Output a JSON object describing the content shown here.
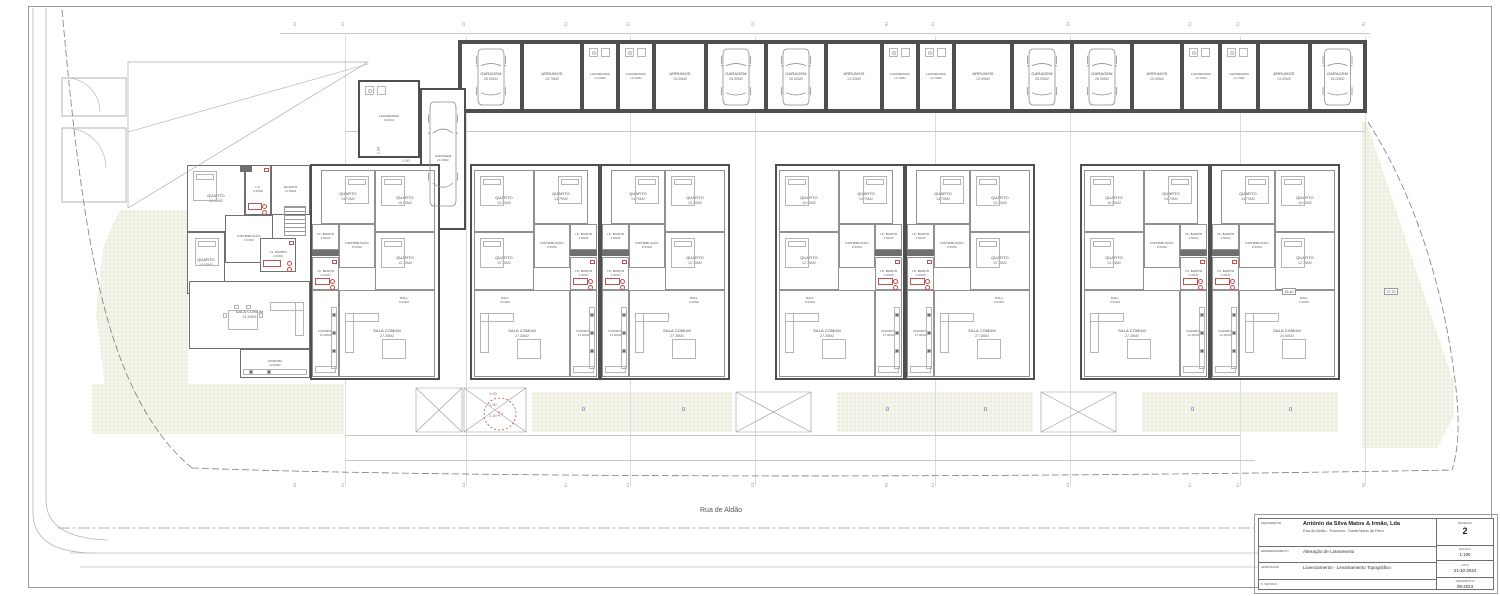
{
  "street": {
    "name": "Rua de Aldão"
  },
  "colors": {
    "wall": "#4f4f4f",
    "partition": "#919191",
    "sanitary_red": "#c0504d",
    "garden_fill": "#f4f4ea",
    "garden_dot": "#c9cfa9",
    "marker_blue": "#4059c8"
  },
  "title_block": {
    "rows": [
      {
        "label": "REQUERENTE",
        "line1": "António da Silva Matos & Irmão, Lda",
        "line2": "Rua de Aldão - Travanca - Santa Maria da Feira"
      },
      {
        "label": "EMPREENDIMENTO",
        "line1": "Alteração de Loteamento",
        "line2": ""
      },
      {
        "label": "APROVAÇÃO",
        "line1": "Licenciamento - Levantamento Topográfico",
        "line2": ""
      },
      {
        "label": "O TÉCNICO",
        "line1": "",
        "line2": ""
      }
    ],
    "meta": [
      {
        "label": "DESENHO",
        "value": "2"
      },
      {
        "label": "ESCALA",
        "value": "1:100"
      },
      {
        "label": "DATA",
        "value": "21-10-2024"
      },
      {
        "label": "REFERÊNCIA",
        "value": "09-2023"
      }
    ]
  },
  "strip_rooms": [
    {
      "x": 460,
      "w": 62,
      "name": "GARAGEM",
      "area": "26.00M2",
      "car": true
    },
    {
      "x": 522,
      "w": 60,
      "name": "ARRUMOS",
      "area": "13.75M2"
    },
    {
      "x": 582,
      "w": 36,
      "name": "LAVANDARIA",
      "area": "13.00M2"
    },
    {
      "x": 618,
      "w": 36,
      "name": "LAVANDARIA",
      "area": "13.00M2"
    },
    {
      "x": 654,
      "w": 52,
      "name": "ARRUMOS",
      "area": "13.00M2"
    },
    {
      "x": 706,
      "w": 60,
      "name": "GARAGEM",
      "area": "26.00M2",
      "car": true
    },
    {
      "x": 766,
      "w": 60,
      "name": "GARAGEM",
      "area": "26.00M2",
      "car": true
    },
    {
      "x": 826,
      "w": 56,
      "name": "ARRUMOS",
      "area": "13.00M2"
    },
    {
      "x": 882,
      "w": 36,
      "name": "LAVANDARIA",
      "area": "12.70M2"
    },
    {
      "x": 918,
      "w": 36,
      "name": "LAVANDARIA",
      "area": "12.70M2"
    },
    {
      "x": 954,
      "w": 58,
      "name": "ARRUMOS",
      "area": "13.00M2"
    },
    {
      "x": 1012,
      "w": 60,
      "name": "GARAGEM",
      "area": "26.00M2",
      "car": true
    },
    {
      "x": 1072,
      "w": 60,
      "name": "GARAGEM",
      "area": "26.00M2",
      "car": true
    },
    {
      "x": 1132,
      "w": 50,
      "name": "ARRUMOS",
      "area": "10.00M2"
    },
    {
      "x": 1182,
      "w": 38,
      "name": "LAVANDARIA",
      "area": "12.70M2"
    },
    {
      "x": 1220,
      "w": 38,
      "name": "LAVANDARIA",
      "area": "12.70M2"
    },
    {
      "x": 1258,
      "w": 52,
      "name": "ARRUMOS",
      "area": "13.00M2"
    },
    {
      "x": 1310,
      "w": 55,
      "name": "GARAGEM",
      "area": "26.00M2",
      "car": true
    }
  ],
  "outbuildings": [
    {
      "name": "LAVANDARIA",
      "area": "6.00M2",
      "x": 358,
      "y": 80,
      "w": 62,
      "h": 78
    },
    {
      "name": "GARAGEM",
      "area": "21.00M2",
      "x": 420,
      "y": 88,
      "w": 46,
      "h": 142,
      "car": true
    }
  ],
  "unit_rooms": [
    {
      "name": "QUARTO",
      "area": "15.00M2",
      "x": 2,
      "y": 4,
      "w": 60,
      "h": 62,
      "furn": "bed"
    },
    {
      "name": "QUARTO",
      "area": "14.70M2",
      "x": 62,
      "y": 4,
      "w": 54,
      "h": 54,
      "furn": "bed2"
    },
    {
      "name": "DISTRIBUIÇÃO",
      "area": "8.50M2",
      "x": 62,
      "y": 58,
      "w": 36,
      "h": 44,
      "small": true
    },
    {
      "name": "I.S. BANHO",
      "area": "4.50M2",
      "x": 98,
      "y": 58,
      "w": 27,
      "h": 26,
      "small": true
    },
    {
      "name": "QUARTO",
      "area": "12.75M2",
      "x": 2,
      "y": 66,
      "w": 60,
      "h": 58,
      "furn": "bed"
    },
    {
      "name": "I.S. BANHO",
      "area": "4.00M2",
      "x": 98,
      "y": 91,
      "w": 27,
      "h": 33,
      "small": true,
      "red": true
    },
    {
      "name": "HALL",
      "area": "9.00M2",
      "x": 16,
      "y": 124,
      "w": 34,
      "h": 22,
      "small": true,
      "open": true
    },
    {
      "name": "SALA COMUM",
      "area": "27.35M2",
      "x": 2,
      "y": 124,
      "w": 96,
      "h": 87,
      "furn": "living"
    },
    {
      "name": "COZINHA",
      "area": "14.00M2",
      "x": 98,
      "y": 124,
      "w": 27,
      "h": 87,
      "furn": "kitchen",
      "small": true
    }
  ],
  "units": [
    {
      "x": 310,
      "mirror": true
    },
    {
      "x": 470,
      "mirror": false
    },
    {
      "x": 600,
      "mirror": true
    },
    {
      "x": 775,
      "mirror": false
    },
    {
      "x": 905,
      "mirror": true
    },
    {
      "x": 1080,
      "mirror": false
    },
    {
      "x": 1210,
      "mirror": true,
      "overrides": {
        "HALL": "6.00M2",
        "SALA COMUM": "24.50M2"
      }
    }
  ],
  "corner_rooms": [
    {
      "name": "QUARTO",
      "area": "13.00M2",
      "x": 187,
      "y": 165,
      "w": 58,
      "h": 67,
      "furn": "bed"
    },
    {
      "name": "I.S.",
      "area": "3.50M2",
      "x": 245,
      "y": 165,
      "w": 26,
      "h": 50,
      "small": true,
      "red": true
    },
    {
      "name": "QUARTO",
      "area": "13.50M2",
      "x": 271,
      "y": 165,
      "w": 39,
      "h": 50,
      "small": true
    },
    {
      "name": "DISTRIBUIÇÃO",
      "area": "7.00M2",
      "x": 225,
      "y": 215,
      "w": 48,
      "h": 48,
      "small": true
    },
    {
      "name": "QUARTO",
      "area": "14.00M2",
      "x": 187,
      "y": 232,
      "w": 38,
      "h": 62,
      "furn": "bed2"
    },
    {
      "name": "I.S. BANHO",
      "area": "4.00M2",
      "x": 260,
      "y": 238,
      "w": 36,
      "h": 34,
      "small": true,
      "red": true
    },
    {
      "name": "HALL",
      "area": "5.00M2",
      "x": 190,
      "y": 283,
      "w": 32,
      "h": 22,
      "small": true,
      "open": true
    },
    {
      "name": "SALA COMUM",
      "area": "21.50M2",
      "x": 189,
      "y": 281,
      "w": 121,
      "h": 68,
      "furn": "dining"
    },
    {
      "name": "COZINHA",
      "area": "12.00M2",
      "x": 240,
      "y": 349,
      "w": 70,
      "h": 29,
      "furn": "kitchen_h",
      "small": true
    }
  ],
  "grid_markers": [
    {
      "x": 297,
      "label": "C3"
    },
    {
      "x": 345,
      "label": "C1"
    },
    {
      "x": 466,
      "label": "C3"
    },
    {
      "x": 568,
      "label": "C1"
    },
    {
      "x": 630,
      "label": "C1"
    },
    {
      "x": 755,
      "label": "C3"
    },
    {
      "x": 888,
      "label": "G1"
    },
    {
      "x": 935,
      "label": "C1"
    },
    {
      "x": 1070,
      "label": "C3"
    },
    {
      "x": 1192,
      "label": "C1"
    },
    {
      "x": 1240,
      "label": "C1"
    },
    {
      "x": 1365,
      "label": "G1"
    }
  ],
  "zeros": [
    {
      "x": 582,
      "y": 407,
      "t": "0"
    },
    {
      "x": 682,
      "y": 407,
      "t": "0"
    },
    {
      "x": 886,
      "y": 407,
      "t": "0"
    },
    {
      "x": 984,
      "y": 407,
      "t": "0"
    },
    {
      "x": 1191,
      "y": 407,
      "t": "0"
    },
    {
      "x": 1289,
      "y": 407,
      "t": "0"
    }
  ],
  "dimensions": [
    {
      "t": "2.98",
      "x": 374,
      "y": 148,
      "rot": true
    },
    {
      "t": "1.50",
      "x": 402,
      "y": 158
    },
    {
      "t": "1.90",
      "x": 489,
      "y": 391
    },
    {
      "t": "1.50",
      "x": 489,
      "y": 402
    },
    {
      "t": "1.20",
      "x": 489,
      "y": 413
    }
  ],
  "levels": [
    {
      "t": "35.40",
      "x": 1282,
      "y": 288
    },
    {
      "t": "37.20",
      "x": 1384,
      "y": 288
    }
  ]
}
